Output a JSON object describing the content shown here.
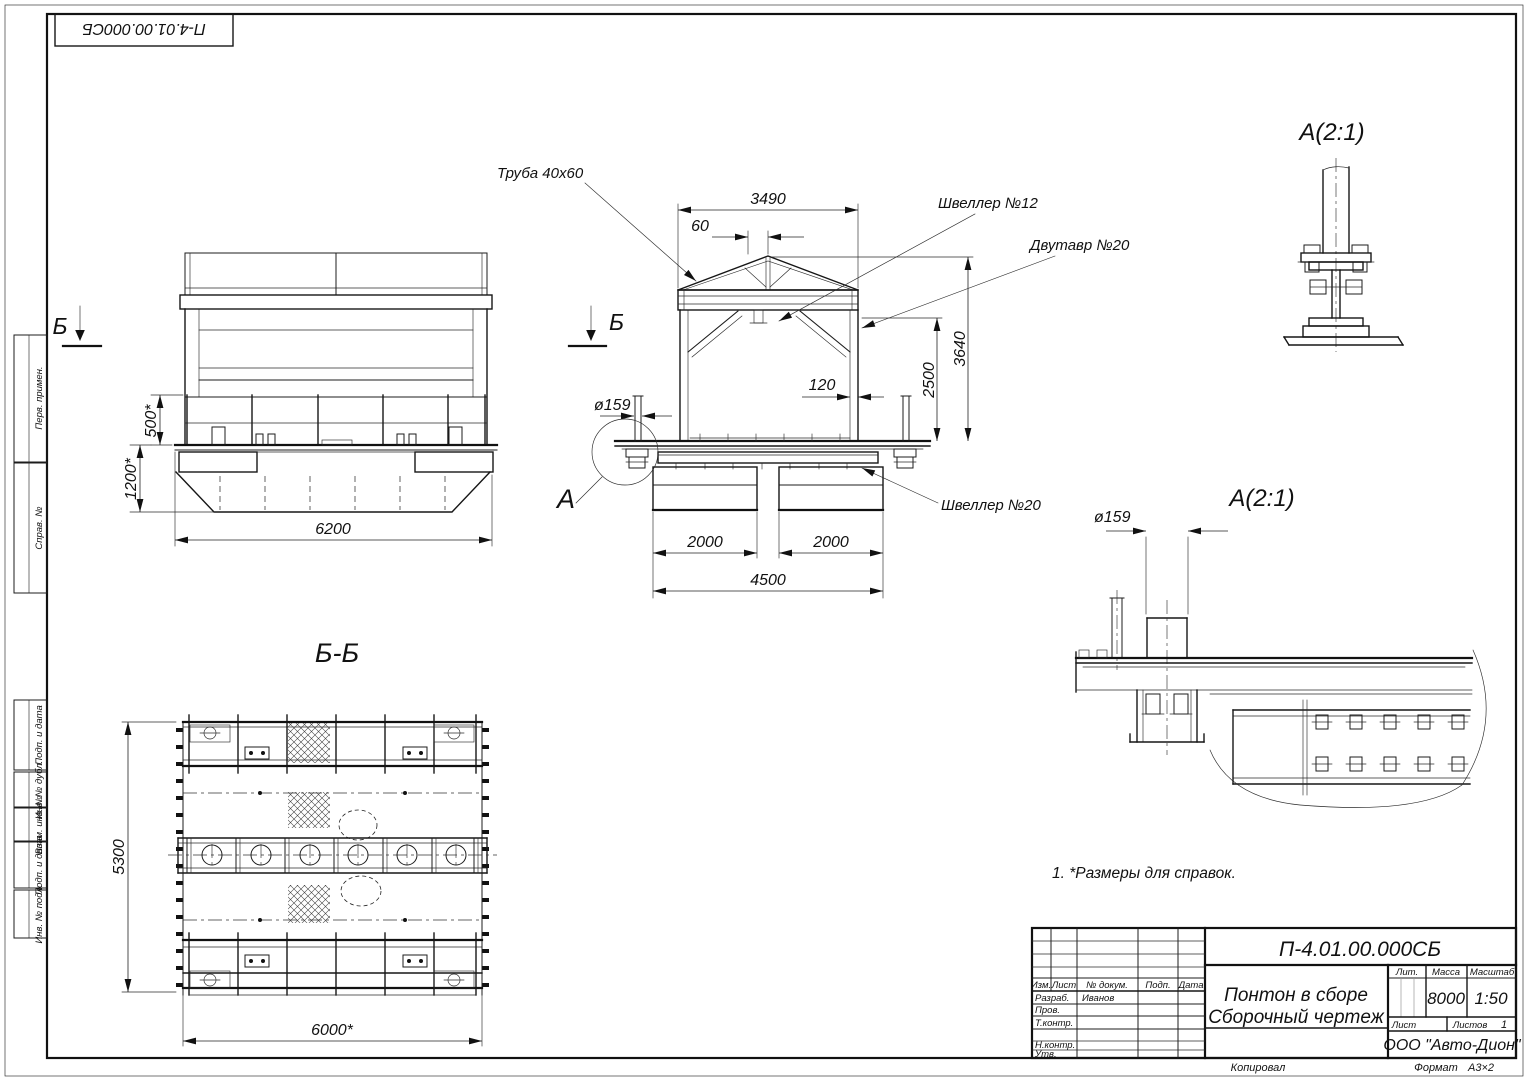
{
  "stamp": {
    "doc_number": "П-4.01.00.000СБ"
  },
  "frame_columns": [
    "Перв. примен.",
    "Справ. №",
    "Подп. и дата",
    "Инв. № дубл.",
    "Взам. инв. №",
    "Подп. и дата",
    "Инв. № подл."
  ],
  "front_view": {
    "section_mark": "Б",
    "dim_rail_height": "500*",
    "dim_hull_height": "1200*",
    "dim_length": "6200"
  },
  "side_view": {
    "section_mark": "Б",
    "detail_mark": "А",
    "label_pipe": "Труба 40х60",
    "label_channel12": "Швеллер №12",
    "label_ibeam20": "Двутавр №20",
    "label_channel20": "Швеллер №20",
    "dim_top_width": "3490",
    "dim_apex_offset": "60",
    "dim_column": "120",
    "dim_column_height": "2500",
    "dim_total_height": "3640",
    "dim_pipe_dia": "ø159",
    "dim_pontoon_left": "2000",
    "dim_pontoon_right": "2000",
    "dim_base_width": "4500"
  },
  "section_view": {
    "title": "Б-Б",
    "dim_width": "5300",
    "dim_length": "6000*"
  },
  "detail_top": {
    "title": "А(2:1)"
  },
  "detail_mid": {
    "title": "А(2:1)",
    "dim_pipe_dia": "ø159"
  },
  "notes": {
    "line1": "1.  *Размеры для справок."
  },
  "title_block": {
    "doc_number": "П-4.01.00.000СБ",
    "title_line1": "Понтон в сборе",
    "title_line2": "Сборочный чертеж",
    "lit_label": "Лит.",
    "mass_label": "Масса",
    "scale_label": "Масштаб",
    "mass_value": "8000",
    "scale_value": "1:50",
    "sheet_label": "Лист",
    "sheets_label": "Листов",
    "sheets_value": "1",
    "company": "ООО \"Авто-Дион\"",
    "col_izm": "Изм.",
    "col_list": "Лист",
    "col_doc": "№ докум.",
    "col_sign": "Подп.",
    "col_date": "Дата",
    "row_developed": "Разраб.",
    "developer_name": "Иванов",
    "row_checked": "Пров.",
    "row_tcontrol": "Т.контр.",
    "row_ncontrol": "Н.контр.",
    "row_approved": "Утв."
  },
  "footer": {
    "copied": "Копировал",
    "format_label": "Формат",
    "format_value": "А3×2"
  }
}
